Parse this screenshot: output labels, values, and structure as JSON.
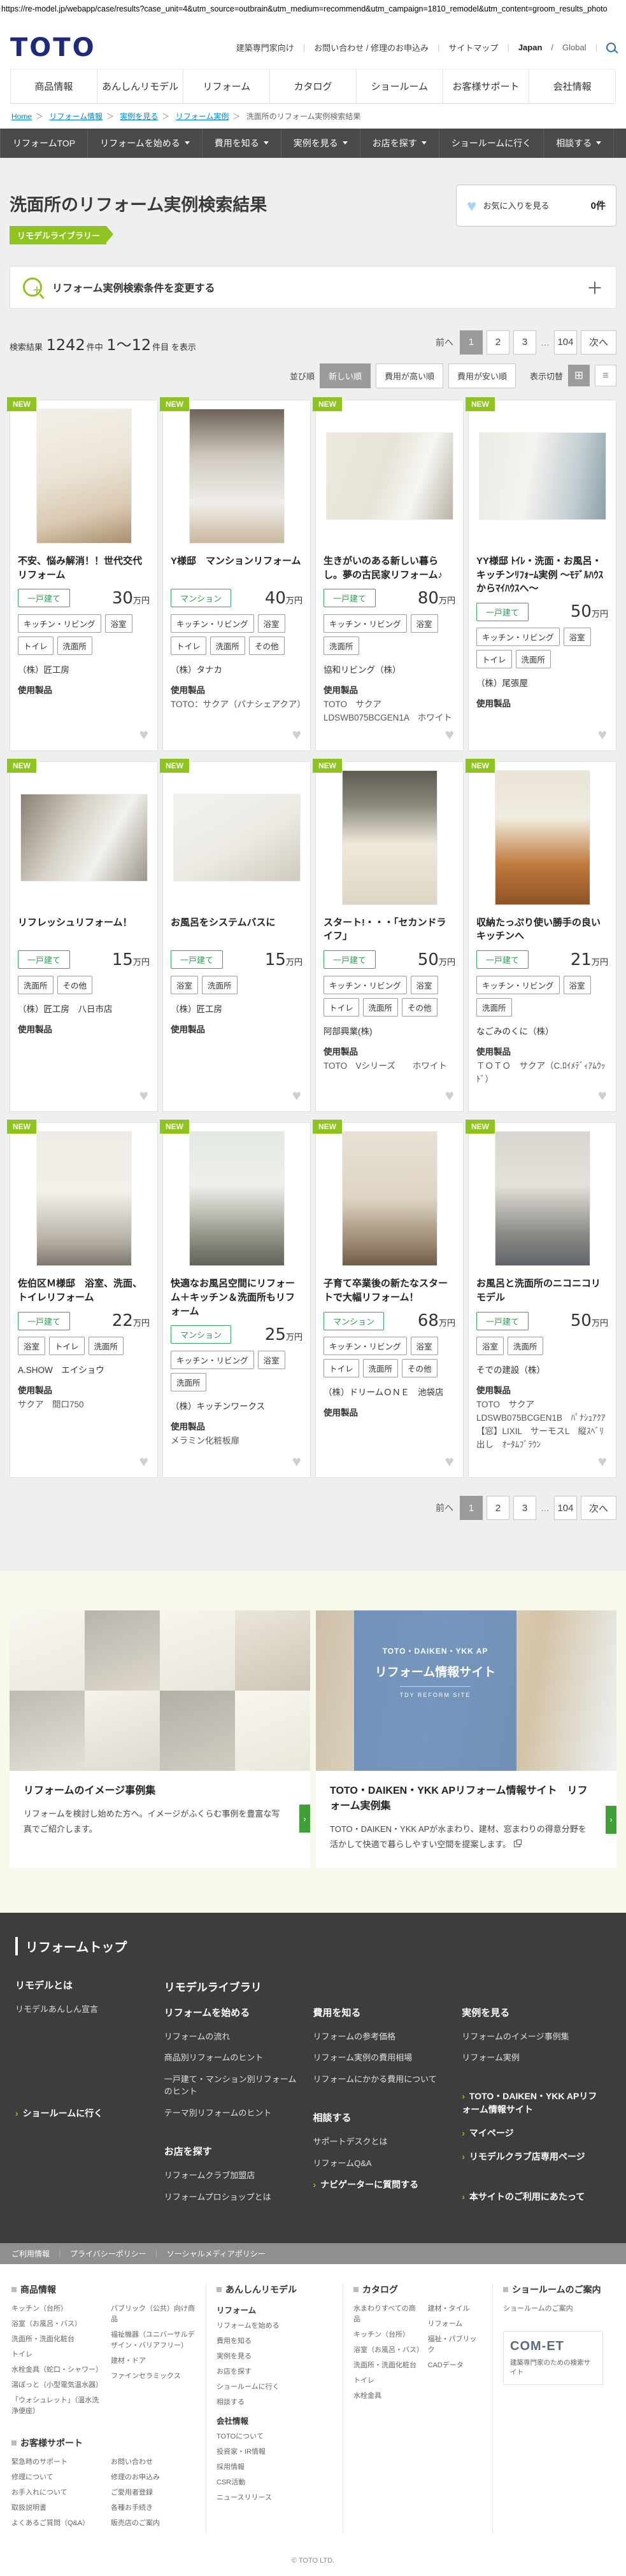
{
  "icons": {
    "chevron": "›",
    "heart": "♥",
    "grid": "⊞",
    "list": "≡",
    "plus": "＋",
    "ellipsis": "…",
    "gt": "＞",
    "bar": "｜",
    "slash": "/"
  },
  "url_bar": "https://re-model.jp/webapp/case/results?case_unit=4&utm_source=outbrain&utm_medium=recommend&utm_campaign=1810_remodel&utm_content=groom_results_photo",
  "header": {
    "logo": "TOTO",
    "utility": [
      "建築専門家向け",
      "お問い合わせ / 修理のお申込み",
      "サイトマップ"
    ],
    "locale_jp": "Japan",
    "locale_global": "Global",
    "nav": [
      "商品情報",
      "あんしんリモデル",
      "リフォーム",
      "カタログ",
      "ショールーム",
      "お客様サポート",
      "会社情報"
    ]
  },
  "breadcrumb": {
    "links": [
      "Home",
      "リフォーム情報",
      "実例を見る",
      "リフォーム実例"
    ],
    "current": "洗面所のリフォーム実例検索結果"
  },
  "subnav": [
    "リフォームTOP",
    "リフォームを始める",
    "費用を知る",
    "実例を見る",
    "お店を探す",
    "ショールームに行く",
    "相談する"
  ],
  "page": {
    "title": "洗面所のリフォーム実例検索結果",
    "badge": "リモデルライブラリー",
    "favorite_label": "お気に入りを見る",
    "favorite_count": "0件",
    "search_bar": "リフォーム実例検索条件を変更する"
  },
  "results": {
    "prefix": "検索結果",
    "total": "1242",
    "unit1": "件中",
    "range": "1〜12",
    "unit2": "件目",
    "suffix": "を表示"
  },
  "pagination": {
    "prev": "前へ",
    "p1": "1",
    "p2": "2",
    "p3": "3",
    "last": "104",
    "next": "次へ"
  },
  "sort": {
    "label": "並び順",
    "opt1": "新しい順",
    "opt2": "費用が高い順",
    "opt3": "費用が安い順",
    "view_label": "表示切替"
  },
  "card_common": {
    "new": "NEW",
    "products_label": "使用製品"
  },
  "cards": [
    {
      "title": "不安、悩み解消！！世代交代リフォーム",
      "type": "一戸建て",
      "price": "30",
      "unit": "万円",
      "tags": [
        "キッチン・リビング",
        "浴室",
        "トイレ",
        "洗面所"
      ],
      "company": "（株）匠工房",
      "products": []
    },
    {
      "title": "Y様邸　マンションリフォーム",
      "type": "マンション",
      "price": "40",
      "unit": "万円",
      "tags": [
        "キッチン・リビング",
        "浴室",
        "トイレ",
        "洗面所",
        "その他"
      ],
      "company": "（株）タナカ",
      "products": [
        "TOTO：サクア（パナシェアクア）"
      ]
    },
    {
      "title": "生きがいのある新しい暮らし。夢の古民家リフォーム♪",
      "type": "一戸建て",
      "price": "80",
      "unit": "万円",
      "tags": [
        "キッチン・リビング",
        "浴室",
        "洗面所"
      ],
      "company": "協和リビング（株）",
      "products": [
        "TOTO　サクア",
        "LDSWB075BCGEN1A　ホワイト"
      ]
    },
    {
      "title": "YY様邸 ﾄｲﾚ・洗面・お風呂・キッチンﾘﾌｫｰﾑ実例 ～ﾓﾃﾞﾙﾊｳｽからﾏｲﾊｳｽへ～",
      "type": "一戸建て",
      "price": "50",
      "unit": "万円",
      "tags": [
        "キッチン・リビング",
        "浴室",
        "トイレ",
        "洗面所"
      ],
      "company": "（株）尾張屋",
      "products": []
    },
    {
      "title": "リフレッシュリフォーム！",
      "type": "一戸建て",
      "price": "15",
      "unit": "万円",
      "tags": [
        "洗面所",
        "その他"
      ],
      "company": "（株）匠工房　八日市店",
      "products": []
    },
    {
      "title": "お風呂をシステムバスに",
      "type": "一戸建て",
      "price": "15",
      "unit": "万円",
      "tags": [
        "浴室",
        "洗面所"
      ],
      "company": "（株）匠工房",
      "products": []
    },
    {
      "title": "スタート!・・・「セカンドライフ」",
      "type": "一戸建て",
      "price": "50",
      "unit": "万円",
      "tags": [
        "キッチン・リビング",
        "浴室",
        "トイレ",
        "洗面所",
        "その他"
      ],
      "company": "阿部興業(株)",
      "products": [
        "TOTO　Vシリーズ　　ホワイト"
      ]
    },
    {
      "title": "収納たっぷり使い勝手の良いキッチンへ",
      "type": "一戸建て",
      "price": "21",
      "unit": "万円",
      "tags": [
        "キッチン・リビング",
        "浴室",
        "洗面所"
      ],
      "company": "なごみのくに（株）",
      "products": [
        "ＴＯＴＯ　サクア（C.ﾛｲﾒﾃﾞｨｱﾑｳｯﾄﾞ）"
      ]
    },
    {
      "title": "佐伯区Ｍ様邸　浴室、洗面、トイレリフォーム",
      "type": "一戸建て",
      "price": "22",
      "unit": "万円",
      "tags": [
        "浴室",
        "トイレ",
        "洗面所"
      ],
      "company": "A.SHOW　エイショウ",
      "products": [
        "サクア　間口750"
      ]
    },
    {
      "title": "快適なお風呂空間にリフォーム＋キッチン＆洗面所もリフォーム",
      "type": "マンション",
      "price": "25",
      "unit": "万円",
      "tags": [
        "キッチン・リビング",
        "浴室",
        "洗面所"
      ],
      "company": "（株）キッチンワークス",
      "products": [
        "メラミン化粧板扉"
      ]
    },
    {
      "title": "子育て卒業後の新たなスタートで大幅リフォーム！",
      "type": "マンション",
      "price": "68",
      "unit": "万円",
      "tags": [
        "キッチン・リビング",
        "浴室",
        "トイレ",
        "洗面所",
        "その他"
      ],
      "company": "（株）ドリームＯＮＥ　池袋店",
      "products": []
    },
    {
      "title": "お風呂と洗面所のニコニコリモデル",
      "type": "一戸建て",
      "price": "50",
      "unit": "万円",
      "tags": [
        "浴室",
        "洗面所"
      ],
      "company": "そでの建設（株）",
      "products": [
        "TOTO　サクア",
        "LDSWB075BCGEN1B　ﾊﾟﾅｼｭｱｸｱ",
        "【窓】LIXIL　サーモスL　縦ｽﾍﾞﾘ出し　ｵｰﾀﾑﾌﾞﾗｳﾝ"
      ]
    }
  ],
  "banners": {
    "left": {
      "title": "リフォームのイメージ事例集",
      "desc": "リフォームを検討し始めた方へ。イメージがふくらむ事例を豊富な写真でご紹介します。"
    },
    "right": {
      "title": "TOTO・DAIKEN・YKK APリフォーム情報サイト　リフォーム実例集",
      "desc": "TOTO・DAIKEN・YKK APが水まわり、建材、窓まわりの得意分野を活かして快適で暮らしやすい空間を提案します。",
      "overlay1": "TOTO・DAIKEN・YKK AP",
      "overlay2": "リフォーム情報サイト",
      "overlay3": "TDY REFORM SITE"
    }
  },
  "footer_dark": {
    "title": "リフォームトップ",
    "remodel_heading": "リモデルとは",
    "remodel_links": [
      "リモデルあんしん宣言"
    ],
    "library_heading": "リモデルライブラリ",
    "start_heading": "リフォームを始める",
    "start_links": [
      "リフォームの流れ",
      "商品別リフォームのヒント",
      "一戸建て・マンション別リフォームのヒント",
      "テーマ別リフォームのヒント"
    ],
    "cost_heading": "費用を知る",
    "cost_links": [
      "リフォームの参考価格",
      "リフォーム実例の費用相場",
      "リフォームにかかる費用について"
    ],
    "case_heading": "実例を見る",
    "case_links": [
      "リフォームのイメージ事例集",
      "リフォーム実例"
    ],
    "showroom": "ショールームに行く",
    "shop_heading": "お店を探す",
    "shop_links": [
      "リフォームクラブ加盟店",
      "リフォームプロショップとは"
    ],
    "consult_heading": "相談する",
    "consult_links": [
      "サポートデスクとは",
      "リフォームQ&A"
    ],
    "navigator": "ナビゲーターに質問する",
    "side1": "TOTO・DAIKEN・YKK APリフォーム情報サイト",
    "side2": "マイページ",
    "side3": "リモデルクラブ店専用ページ",
    "side4": "本サイトのご利用にあたって"
  },
  "legal": [
    "ご利用情報",
    "プライバシーポリシー",
    "ソーシャルメディアポリシー"
  ],
  "footer": {
    "products_heading": "商品情報",
    "products_col1": [
      "キッチン（台所）",
      "浴室（お風呂・バス）",
      "洗面所・洗面化粧台",
      "トイレ",
      "水栓金具（蛇口・シャワー）",
      "湯ぽっと（小型電気温水器）",
      "「ウォシュレット」（温水洗浄便座）"
    ],
    "products_col2": [
      "パブリック（公共）向け商品",
      "福祉機器（ユニバーサルデザイン・バリアフリー）",
      "建材・ドア",
      "ファインセラミックス"
    ],
    "support_heading": "お客様サポート",
    "support_col1": [
      "緊急時のサポート",
      "修理について",
      "お手入れについて",
      "取扱説明書",
      "よくあるご質問（Q&A）"
    ],
    "support_col2": [
      "お問い合わせ",
      "修理のお申込み",
      "ご愛用者登録",
      "各種お手続き",
      "販売店のご案内"
    ],
    "remodel_heading": "あんしんリモデル",
    "reform_sub": "リフォーム",
    "reform_links": [
      "リフォームを始める",
      "費用を知る",
      "実例を見る",
      "お店を探す",
      "ショールームに行く",
      "相談する"
    ],
    "company_sub": "会社情報",
    "company_links": [
      "TOTOについて",
      "投資家・IR情報",
      "採用情報",
      "CSR活動",
      "ニュースリリース"
    ],
    "catalog_heading": "カタログ",
    "catalog_col1": [
      "水まわりすべての商品",
      "キッチン（台所）",
      "浴室（お風呂・バス）",
      "洗面所・洗面化粧台",
      "トイレ",
      "水栓金具"
    ],
    "catalog_col2": [
      "建材・タイル",
      "リフォーム",
      "福祉・パブリック",
      "CADデータ"
    ],
    "showroom_heading": "ショールームのご案内",
    "showroom_links": [
      "ショールームのご案内"
    ],
    "comet_logo": "COM-ET",
    "comet_caption": "建築専門家のための検索サイト"
  },
  "copyright": "© TOTO LTD."
}
